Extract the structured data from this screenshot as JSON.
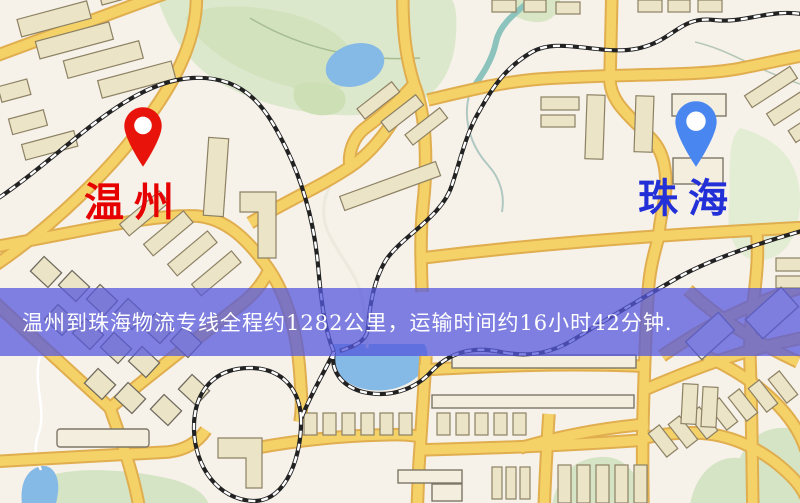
{
  "markers": {
    "origin": {
      "label": "温州",
      "pin_color": "#e8140c",
      "label_color": "#e60000"
    },
    "destination": {
      "label": "珠海",
      "pin_color": "#4a86f0",
      "label_color": "#2330d8"
    }
  },
  "banner": {
    "text": "温州到珠海物流专线全程约1282公里，运输时间约16小时42分钟.",
    "background": "rgba(85,88,220,0.75)",
    "text_color": "#ffffff"
  },
  "route_info": {
    "origin": "温州",
    "destination": "珠海",
    "distance_text": "约1282公里",
    "duration_text": "约16小时42分钟"
  },
  "map_colors": {
    "background": "#f6f1e9",
    "park": "#dce8cc",
    "water": "#85b9e6",
    "road": "#f5d268",
    "road_casing": "#e0ae4f",
    "railway": "#222222",
    "building": "#ece4c6"
  }
}
